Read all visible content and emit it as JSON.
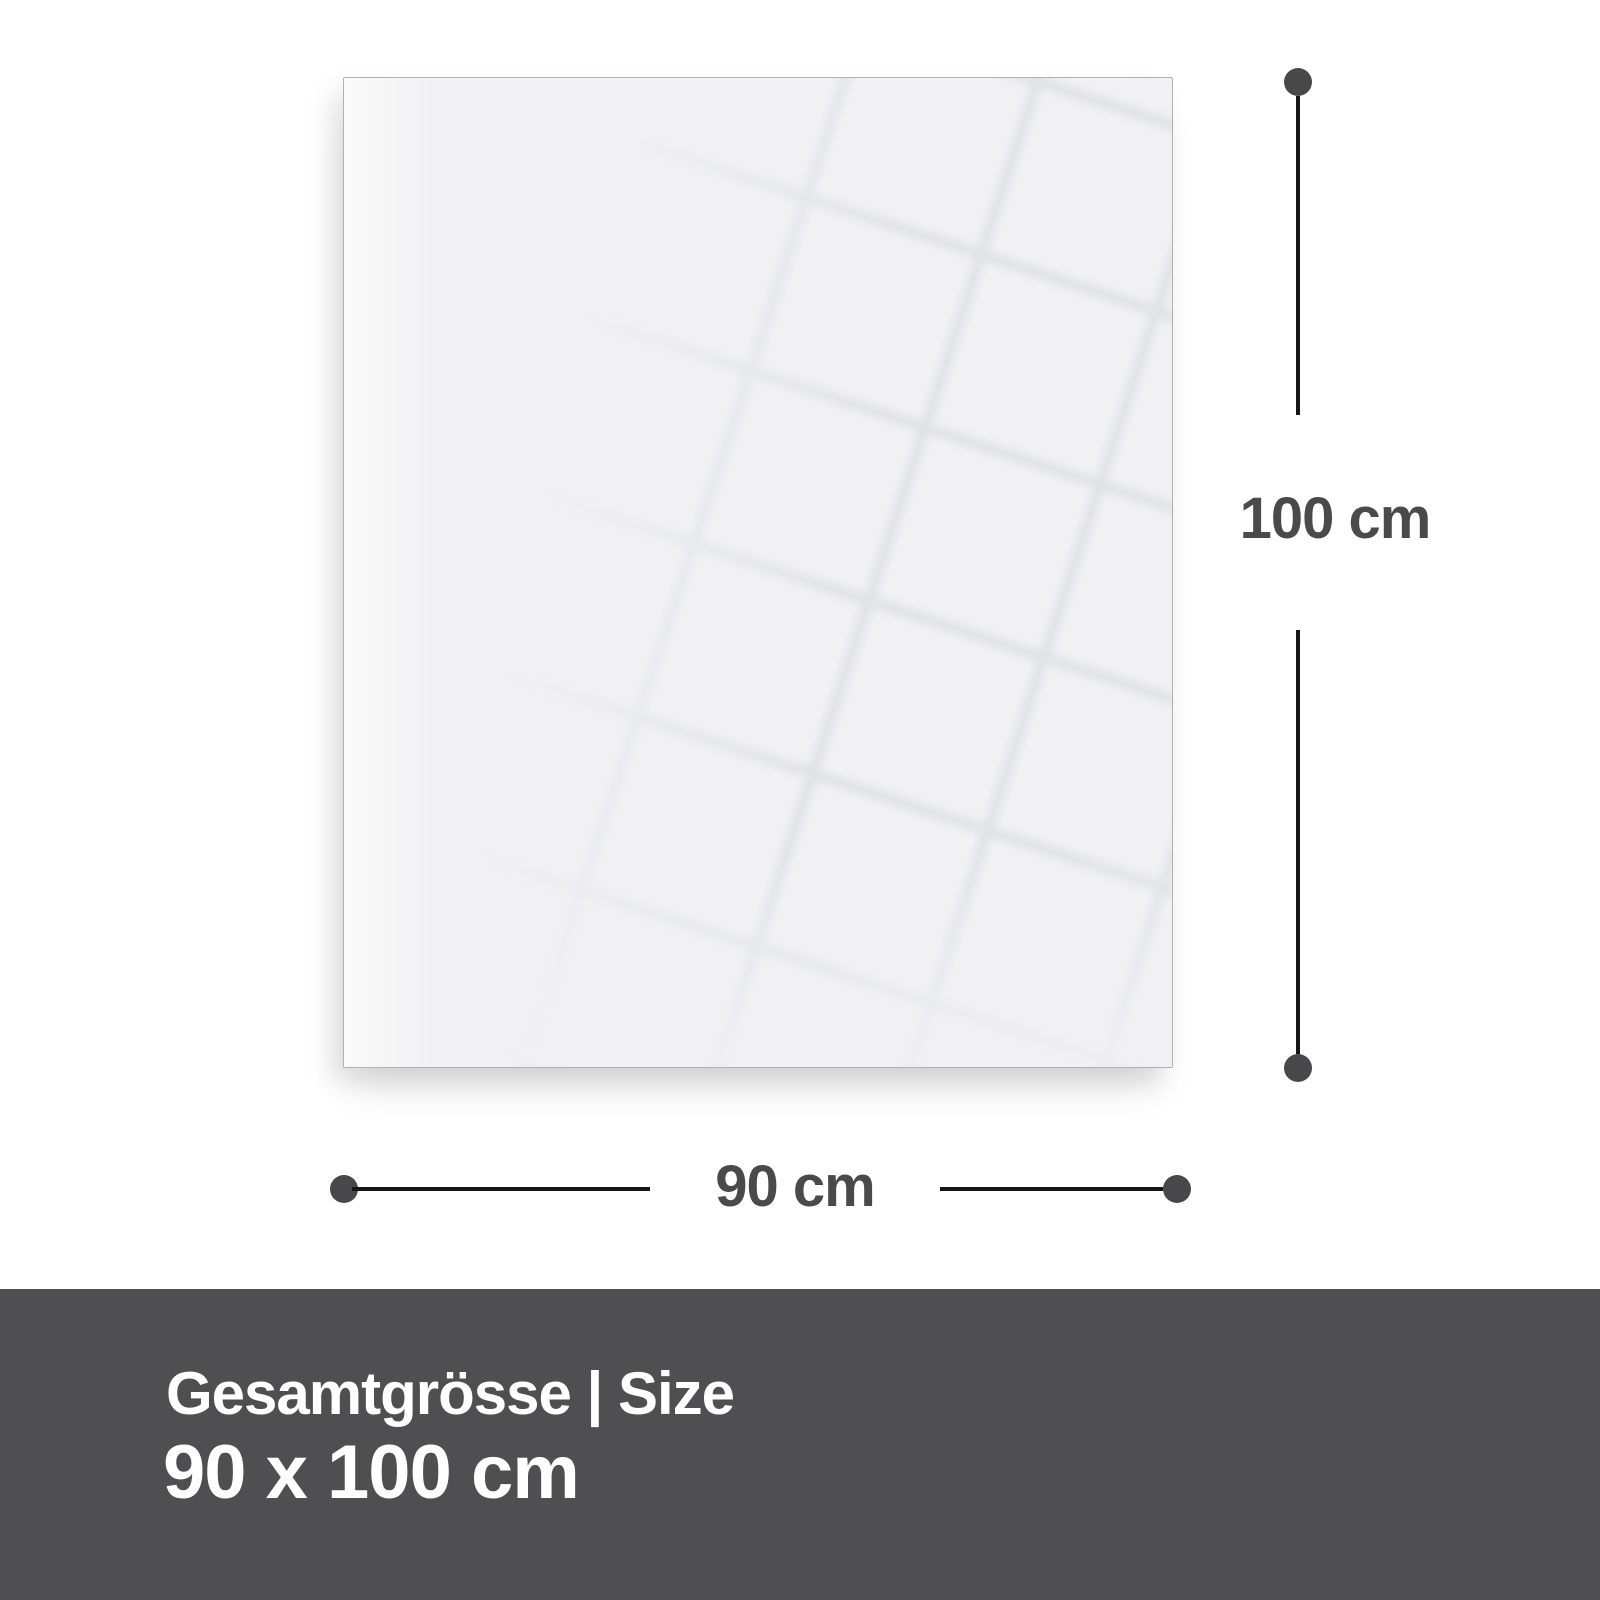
{
  "canvas": {
    "width_px": 1600,
    "height_px": 1600,
    "background": "#ffffff"
  },
  "diagram": {
    "panel": {
      "description": "blank glossy panel with faint tilted window reflection grid"
    },
    "height_dimension": {
      "label": "100 cm"
    },
    "width_dimension": {
      "label": "90 cm"
    }
  },
  "footer": {
    "title": "Gesamtgrösse | Size",
    "size_value": "90 x 100 cm"
  },
  "colors": {
    "page_background": "#ffffff",
    "panel_fill": "#f1f1f3",
    "panel_border": "#b0b0b5",
    "reflection_line": "#e3e5e9",
    "dimension_line": "#161616",
    "dimension_dot": "#48484a",
    "dimension_label": "#4a4a4c",
    "footer_background": "#4f4f51",
    "footer_text": "#ffffff"
  }
}
